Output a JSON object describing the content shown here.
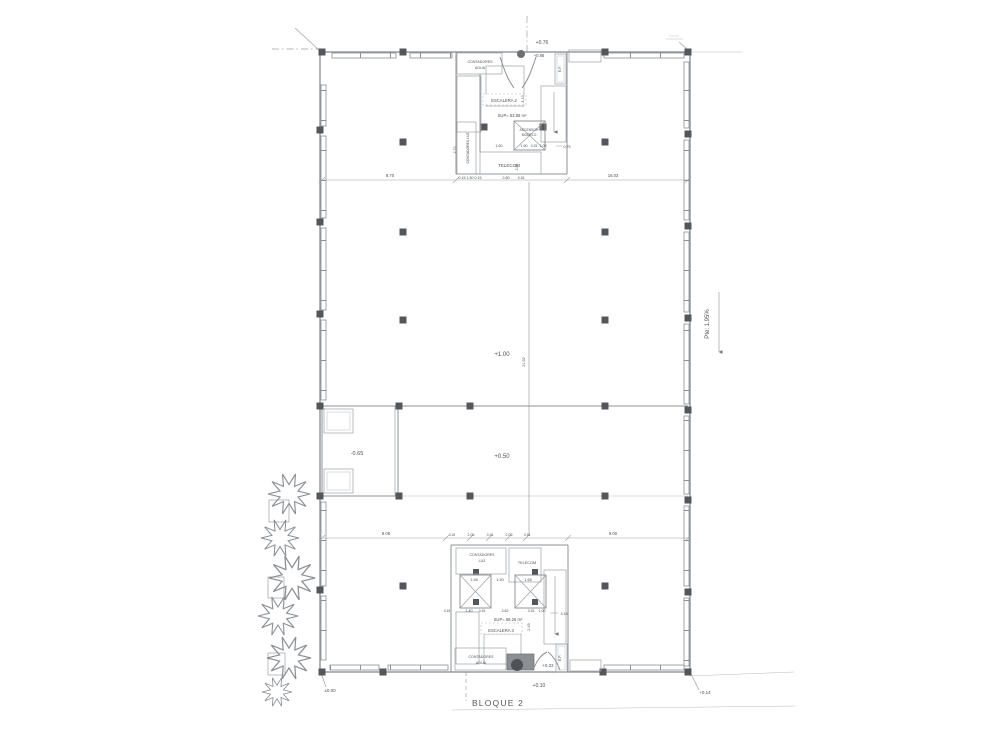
{
  "plan": {
    "block_label": "BLOQUE 2",
    "slope_label": "Pte: 1.95%",
    "levels": {
      "top": "+0.76",
      "top_entry": "+0.88",
      "upper_hall": "+1.00",
      "lower_hall": "+0.50",
      "pit": "-0.65",
      "ground": "±0.00",
      "bottom_lobby": "+0.22",
      "bottom_entry": "+0.10",
      "corner": "+0.14"
    },
    "rooms": {
      "contadores_line1": "CONTADORES",
      "agua_line2": "AGUA",
      "luz_line2": "LUZ",
      "contadores_luz": "CONTADORES LUZ",
      "telecom": "TELECOM",
      "escalera_2": "ESCALERA 2",
      "escalera_3": "ESCALERA 3",
      "ascensor_line1": "ASCENSOR",
      "ascensor_line2": "MODELO",
      "ep": "E.P.",
      "sup_top": "SUP= 53.88 m²",
      "sup_bottom": "SUP= 58.26 m²"
    },
    "dims": {
      "top_left": "8.70",
      "top_right": "16.03",
      "mid_vertical": "21.52",
      "bottom_left": "8.08",
      "bottom_right": "9.00",
      "core_b_seg1": "0.15",
      "core_b_seg2": "2.05",
      "core_b_seg3": "0.15",
      "core_b_seg4": "2.05",
      "core_b_seg5": "0.15",
      "t_160": "1.60",
      "t_190": "1.90",
      "t_015": "0.15",
      "t_100": "1.00",
      "t_075": "0.75",
      "t_row2a": "0.15 1.50 0.15",
      "t_280": "2.80",
      "t_row2c": "0.15",
      "v_273": "2.73",
      "v_343": "3.43",
      "v_220": "2.20",
      "v_245": "2.45",
      "m_165a": "1.65",
      "m_150": "1.50",
      "m_165b": "1.65",
      "c_015a": "0.15",
      "c_140": "1.40",
      "c_015b": "0.15",
      "c_362": "3.62",
      "c_015c": "0.15",
      "c_100": "1.00",
      "c_315": "3.15"
    }
  }
}
